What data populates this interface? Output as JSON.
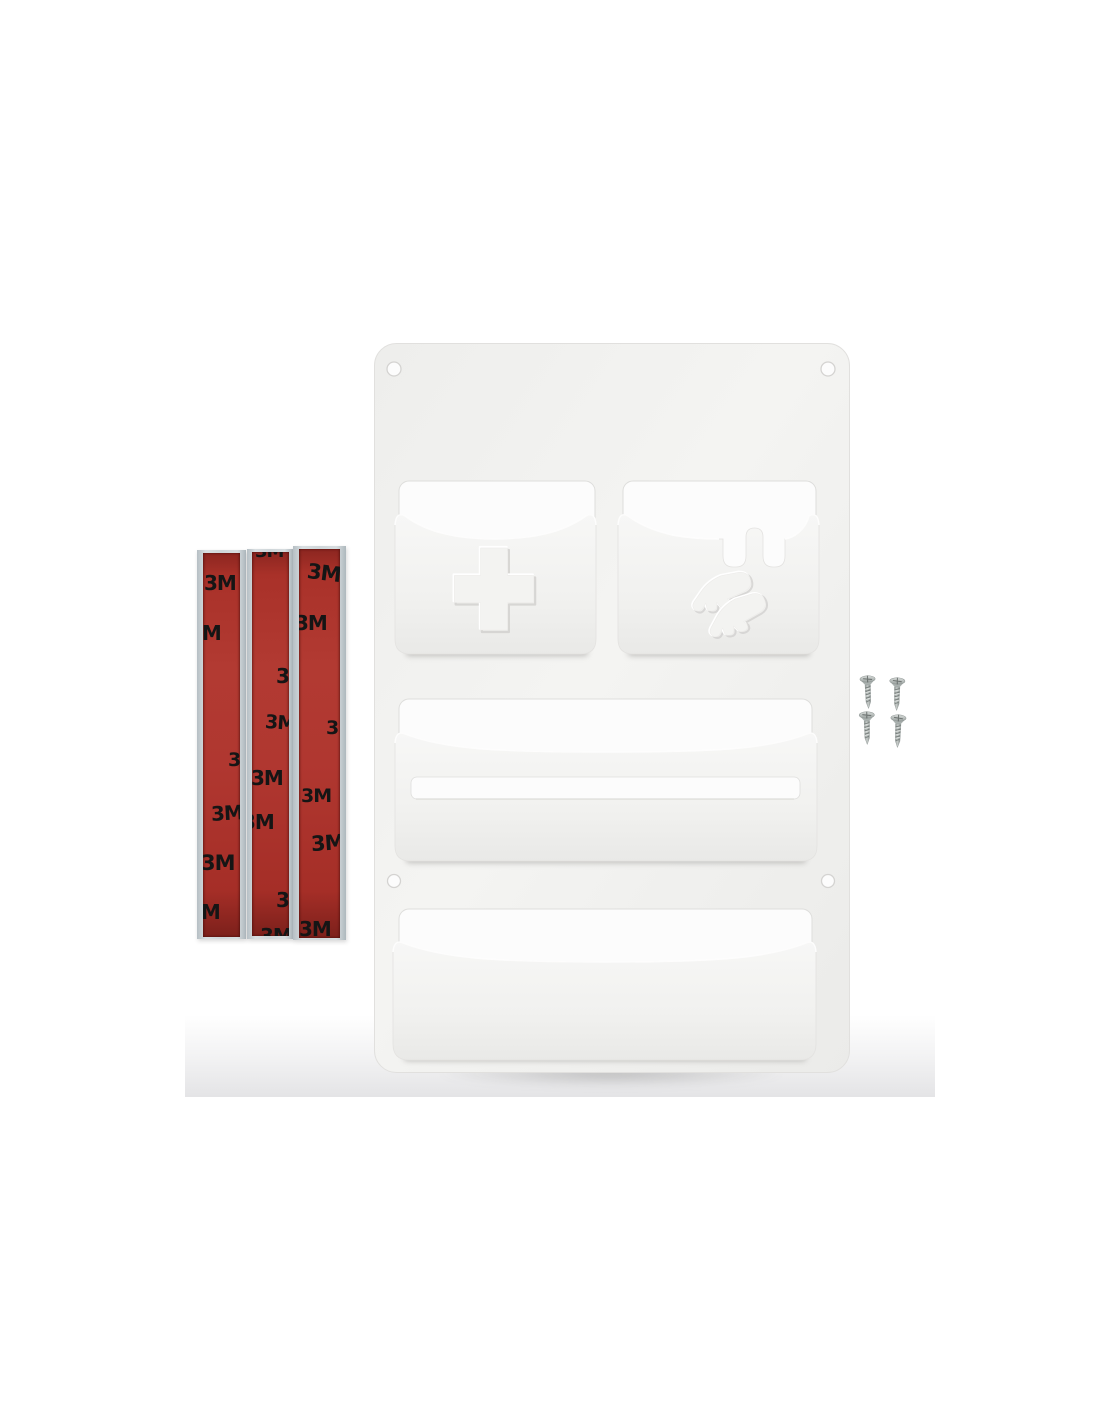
{
  "photo": {
    "background_color": "#ffffff",
    "floor_shade_color": "#e4e4e6"
  },
  "organizer": {
    "panel_color": "#f2f2f0",
    "cutout_color": "#fcfcfc",
    "mounting_hole_count": 4,
    "pockets": {
      "first_aid": {
        "icon": "medical-cross-emboss"
      },
      "gloves": {
        "icon": "gloves-emboss",
        "scissor_slot_count": 2
      },
      "middle": {
        "slot_count": 1
      },
      "bottom": {
        "slot_count": 0
      }
    }
  },
  "adhesive_strips": {
    "count": 3,
    "brand_text": "3M",
    "tape_color": "#ac322b",
    "liner_color": "#ccd3d6",
    "logo_color": "#151515"
  },
  "screws": {
    "count": 4,
    "color": "#a3aaa8"
  }
}
